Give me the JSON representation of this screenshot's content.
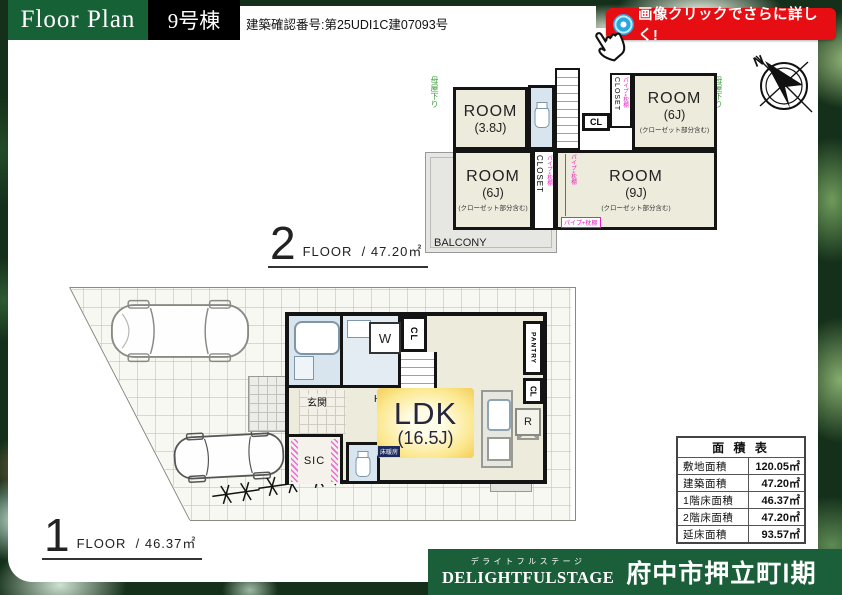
{
  "header": {
    "title": "Floor Plan",
    "building": "9号棟",
    "confirmation": "建築確認番号:第25UDI1C建07093号",
    "badge_label": "画像クリックでさらに詳しく!"
  },
  "compass": {
    "north": "N"
  },
  "texts": {
    "room": "ROOM",
    "closet_note": "(クローゼット部分含む)",
    "pipe_shelf": "パイプ+枕棚",
    "eaves_note": "母屋下り",
    "closet": "CLOSET",
    "cl": "CL",
    "dn": "DN",
    "up": "UP",
    "balcony": "BALCONY",
    "pantry": "PANTRY",
    "washer": "W",
    "fridge": "R",
    "genkan": "玄関",
    "hall": "HALL",
    "sic": "SIC",
    "floor_heating": "床暖房"
  },
  "floor2": {
    "number": "2",
    "floor_word": "FLOOR",
    "area": "/ 47.20㎡",
    "room38_size": "(3.8J)",
    "room6a_size": "(6J)",
    "room6b_size": "(6J)",
    "room9_size": "(9J)"
  },
  "floor1": {
    "number": "1",
    "floor_word": "FLOOR",
    "area": "/ 46.37㎡",
    "ldk": "LDK",
    "ldk_size": "(16.5J)"
  },
  "area_table": {
    "title": "面 積 表",
    "rows": [
      {
        "label": "敷地面積",
        "value": "120.05㎡"
      },
      {
        "label": "建築面積",
        "value": "47.20㎡"
      },
      {
        "label": "1階床面積",
        "value": "46.37㎡"
      },
      {
        "label": "2階床面積",
        "value": "47.20㎡"
      },
      {
        "label": "延床面積",
        "value": "93.57㎡"
      }
    ]
  },
  "brand": {
    "kana": "デライトフルステージ",
    "en": "DELIGHTFULSTAGE",
    "name": "府中市押立町Ⅰ期"
  }
}
